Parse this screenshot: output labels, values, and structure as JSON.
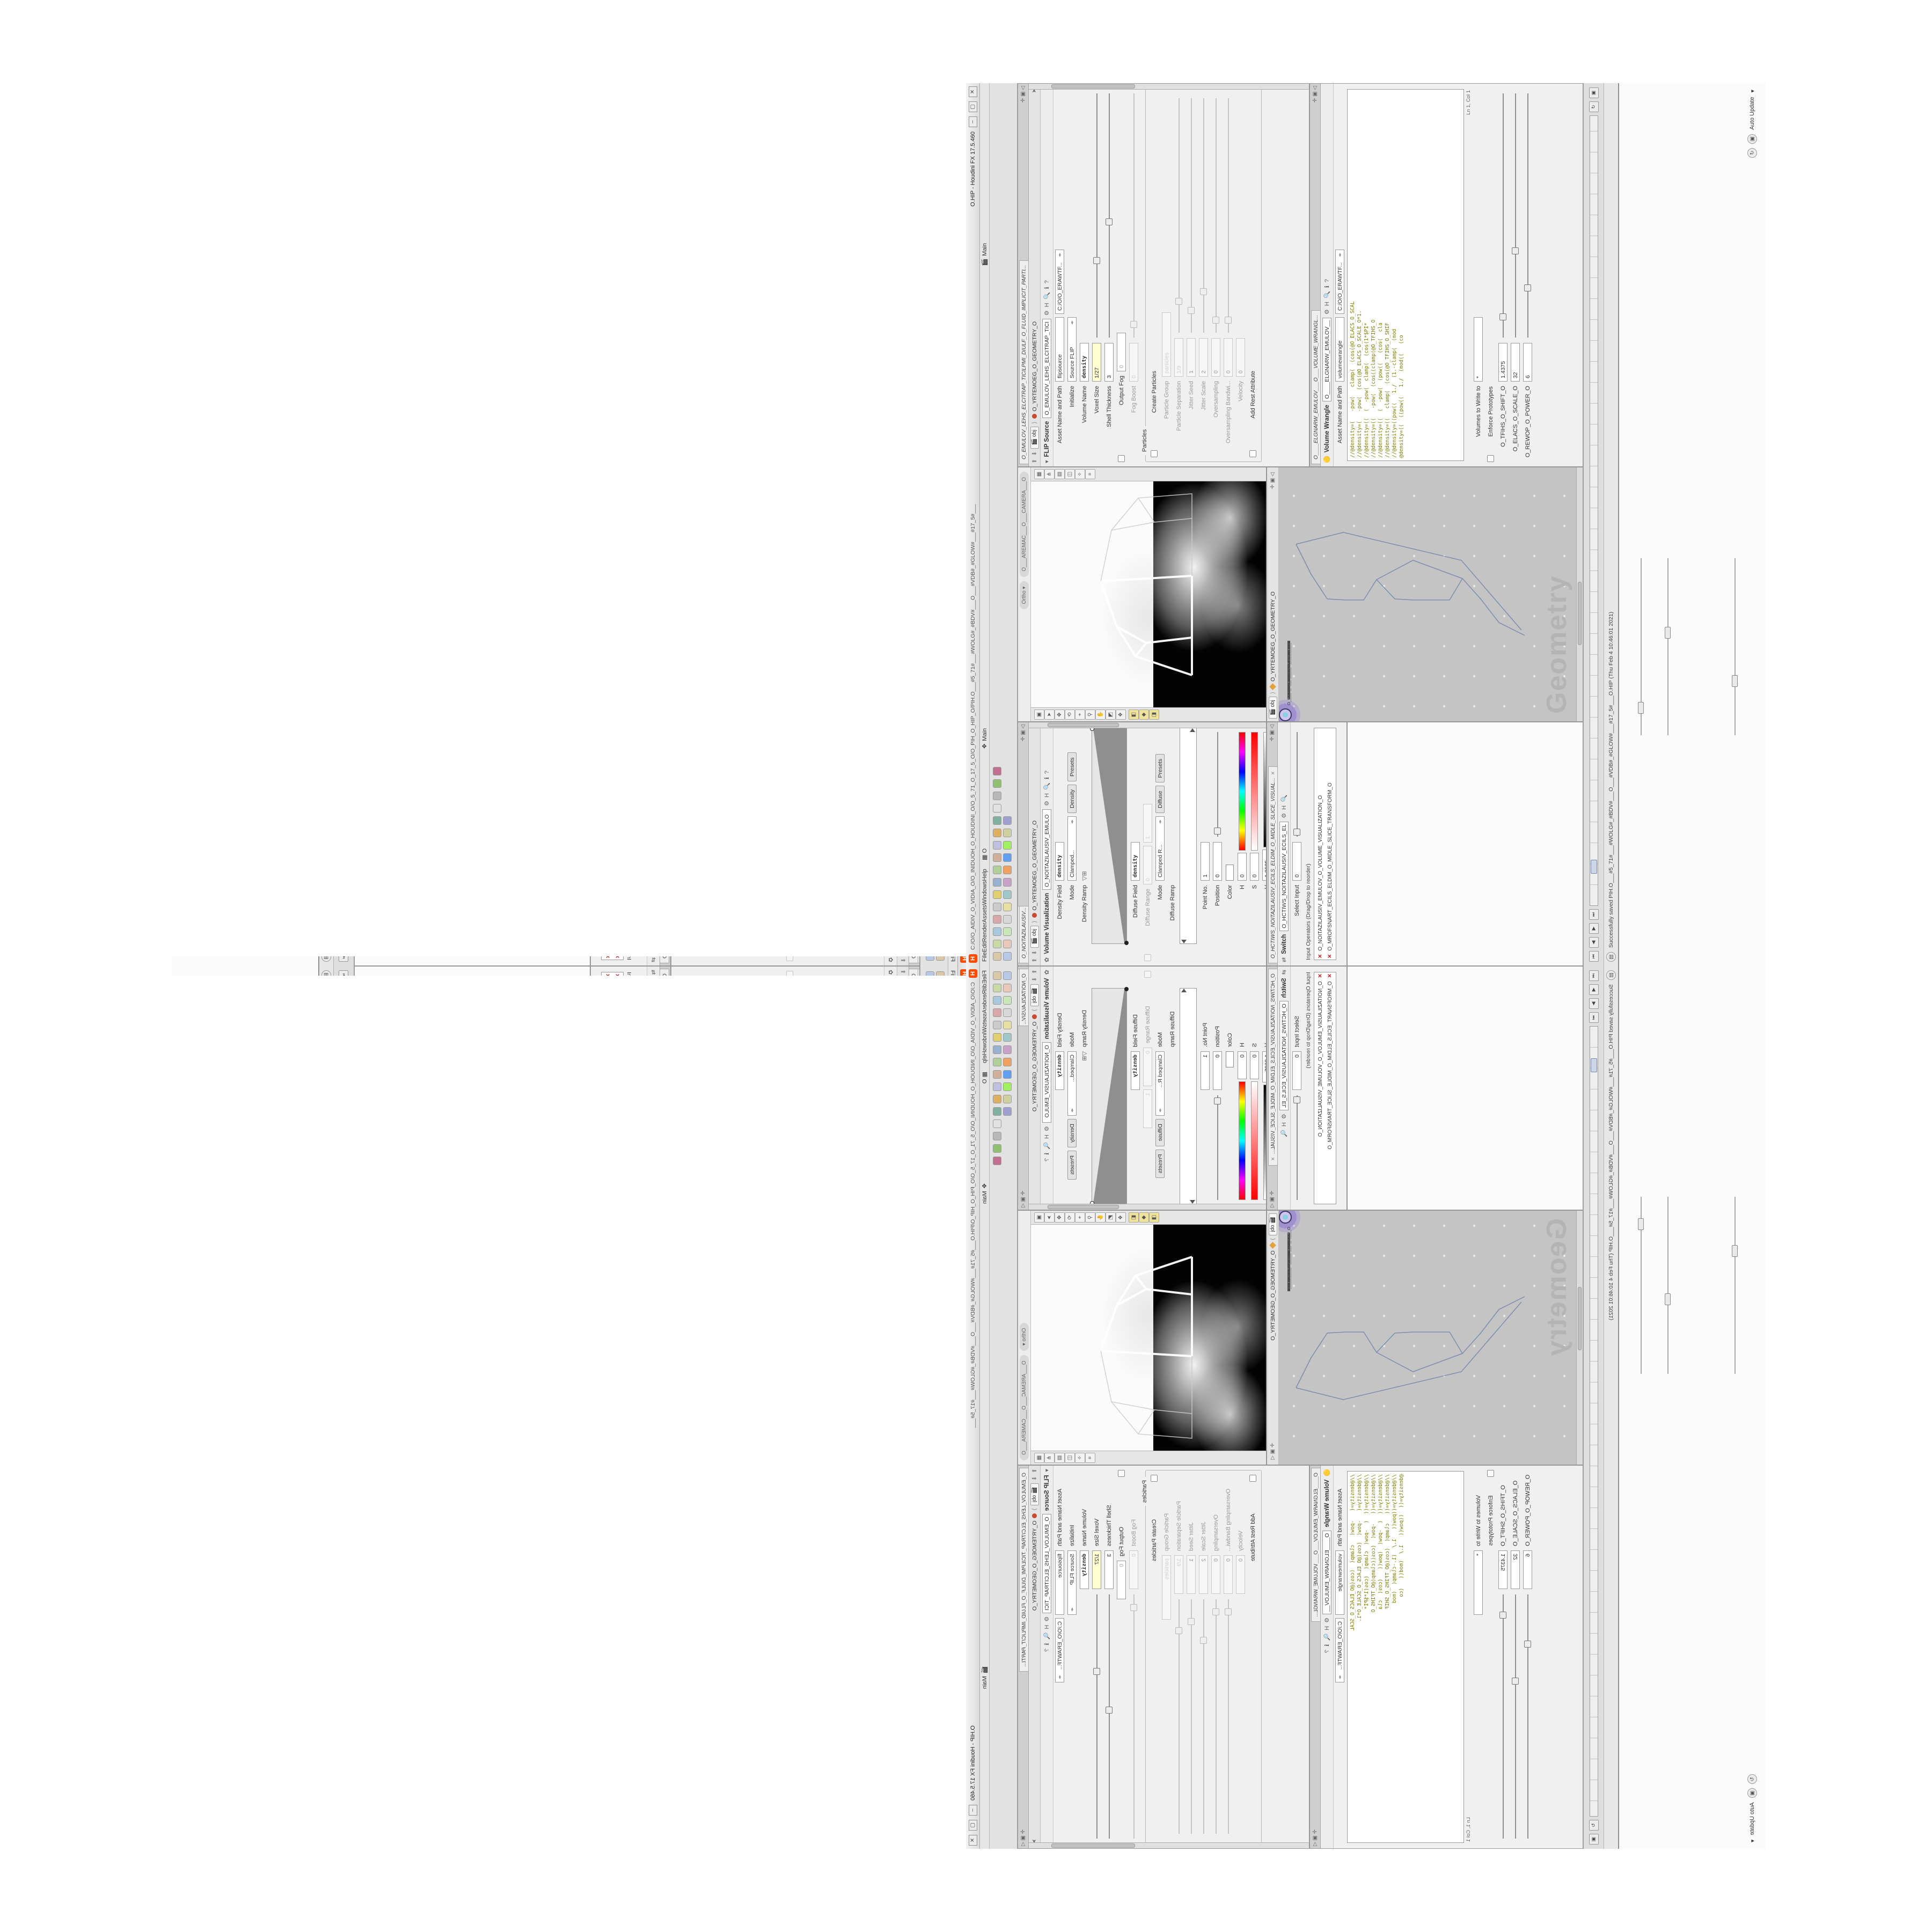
{
  "window": {
    "logo": "H",
    "title_path": "C:/O/O_AIDIV_O_VIDIA_O/O_INIDUOH_O_HOUDINI_O/O_5_71_O_17_5_O/O_PIH_O_HIP_O/PIH.O___#5_71#___#WOLG#_#BDV#___O___#VDB#_#GLOW#___#17_5#___",
    "title_app": "O.HIP - Houdini FX 17.5.460",
    "btn_min": "–",
    "btn_max": "▢",
    "btn_close": "✕"
  },
  "menu": {
    "items": [
      {
        "label": "File"
      },
      {
        "label": "Edit"
      },
      {
        "label": "Render"
      },
      {
        "label": "Assets"
      },
      {
        "label": "Windows"
      },
      {
        "label": "Help"
      }
    ],
    "grid_icon": "▦",
    "grid_label": "O",
    "desktop_label": "Main",
    "desktop_label2": "Main"
  },
  "shelf": {
    "row1": [
      {
        "style": "background:#d9c9a8"
      },
      {
        "style": "background:#c9d9a8"
      },
      {
        "style": "background:#a8c9d9"
      },
      {
        "style": "background:#d9a8a8"
      },
      {
        "style": "background:#cccccc"
      },
      {
        "style": "background:#e0d070"
      },
      {
        "style": "background:#9ab0d0"
      },
      {
        "style": "background:#b0d09a"
      },
      {
        "style": "background:#d0b09a"
      },
      {
        "style": "background:#c0c0e0"
      },
      {
        "style": "background:#e0b060"
      },
      {
        "style": "background:#80b0a0"
      },
      {
        "style": "background:#d490689"
      },
      {
        "style": "background:#b8b8b8"
      },
      {
        "style": "background:#90c070"
      },
      {
        "style": "background:#c07090"
      }
    ],
    "row2": [
      {
        "style": "background:#b8c8e8"
      },
      {
        "style": "background:#e8c8b8"
      },
      {
        "style": "background:#c8e8b8"
      },
      {
        "style": "background:#d8d8d8"
      },
      {
        "style": "background:#e8e0a0"
      },
      {
        "style": "background:#a0c8c8"
      },
      {
        "style": "background:#c8a0c8"
      },
      {
        "style": "background:#f0a060"
      },
      {
        "style": "background:#60a0f0"
      },
      {
        "style": "background:#a0f060"
      },
      {
        "style": "background:#d0d0a0"
      },
      {
        "style": "background:#a0a0d0"
      }
    ]
  },
  "breadcrumb": {
    "root": "obj",
    "node": "O_YRTEMOEG_O_GEOMETRY_O"
  },
  "volviz": {
    "tabs": [
      {
        "label": "O___ARTNAM_...",
        "close": "✕"
      },
      {
        "label": "O___AREMAC_...",
        "close": "✕"
      },
      {
        "label": "O_NOITAZILAUSIV...",
        "close": "✕"
      }
    ],
    "icon": "✿",
    "title": "Volume Visualization",
    "name_field": "O_NOITAZILAUSIV_EMULO",
    "rows": {
      "density_field_label": "Density Field",
      "density_field_value": "density",
      "mode_label": "Mode",
      "mode_value": "Clamped...",
      "mode_btn1": "Density",
      "mode_btn2": "Presets",
      "density_ramp_label": "Density Ramp",
      "diffuse_field_label": "Diffuse Field",
      "diffuse_field_value": "density",
      "diffuse_range_label": "Diffuse Range",
      "diffuse_range_v1": "0",
      "diffuse_range_v2": "1",
      "mode2_label": "Mode",
      "mode2_value": "Clamped R...",
      "mode2_btn1": "Diffuse",
      "mode2_btn2": "Presets",
      "diffuse_ramp_label": "Diffuse Ramp",
      "point_label": "Point No.",
      "point_value": "1",
      "pos_label": "Position",
      "pos_value": "0",
      "color_label": "Color",
      "h_label": "H",
      "h_value": "0",
      "s_label": "S",
      "s_value": "0",
      "v_label": "V",
      "v_value": "1.8125",
      "interp_label": "Interpolation",
      "interp_value": "Linear"
    }
  },
  "switch": {
    "tab": "O_HCTIWS_NOITAZILAUSIV_ECILS_ELDIM_O_MIDLE_SLICE_VISUAL...",
    "icon": "⇄",
    "title": "Switch",
    "name_field": "O_HCTIWS_NOITAZILAUSIV_ECILS_EL",
    "select_label": "Select Input",
    "select_value": "0",
    "list_label": "Input Operators (Drag/Drop to reorder)",
    "items": [
      {
        "x": "✕",
        "name": "O_NOITAZILAUSIV_EMULOV_O_VOLUME_VISUALIZATION_O"
      },
      {
        "x": "✕",
        "name": "O_MROFSNART_ECILS_ELDIM_O_MIDLE_SLICE_TRANSFORM_O"
      }
    ]
  },
  "viewport": {
    "ortho": "Ortho",
    "camera": "O___AREMAC___O___CAMERA___O",
    "left_icons": [
      {
        "g": "▣"
      },
      {
        "g": "➤"
      },
      {
        "g": "✥"
      },
      {
        "g": "⟲"
      },
      {
        "g": "⌖"
      },
      {
        "g": "⚲"
      },
      {
        "g": "✋"
      },
      {
        "g": "◩"
      },
      {
        "g": "❖"
      }
    ],
    "left_icons_yellow": [
      {
        "g": "◧"
      },
      {
        "g": "◆"
      },
      {
        "g": "◨"
      }
    ],
    "right_icons": [
      {
        "g": "▦"
      },
      {
        "g": "⋔"
      },
      {
        "g": "▤"
      },
      {
        "g": "◫"
      },
      {
        "g": "✧"
      },
      {
        "g": "⌗"
      }
    ]
  },
  "network": {
    "watermark": "Geometry",
    "nodes": [
      {
        "name": "O_EREHPS_EBUC_O_CUBE_SPHERE_O",
        "pos": "left:318px;top:18px",
        "dot": "background:#3f9e57",
        "cls": "node"
      },
      {
        "name": "O_ERIWYLOP_O_POLYWIRE_O",
        "pos": "left:260px;top:48px",
        "dot": "background:#8899aa",
        "cls": "node"
      },
      {
        "name": "O_ELIF_O_FILE_O",
        "pos": "left:214px;top:78px",
        "dot": "background:#b0b0b0",
        "cls": "node"
      },
      {
        "name": "O_HCTIWS_YRTEMOEG_O_GEOMETRY_SWITCH_O",
        "pos": "left:214px;top:112px",
        "dot": "background:#777777",
        "cls": "node"
      },
      {
        "name": "O_PILC_O_CLIP_O",
        "pos": "left:214px;top:146px",
        "dot": "background:#d88840",
        "cls": "node"
      },
      {
        "name": "O_PILC_ELDIM_O_MIDLE_CLIP_O",
        "pos": "left:254px;top:170px",
        "dot": "background:#d88840",
        "cls": "node"
      },
      {
        "name": "O_EMULOV_LEHS_ELCITRAP_TICILPMI_DIULF_O",
        "pos": "left:214px;top:204px",
        "dot": "background:#cccccc",
        "cls": "node"
      },
      {
        "name": "O_SNOGYLOP_MORF_BDV_O_VDB_FROM_POLYGONS_O",
        "pos": "left:214px;top:238px",
        "dot": "background:#c86060",
        "cls": "node"
      },
      {
        "name": "O____ELGNARW_EMULOV_O_VOLUME_WRANGLE____O",
        "pos": "left:214px;top:272px",
        "dot": "background:#c8b840",
        "cls": "node"
      },
      {
        "name": "O_NOITAZILAUSIV_EMULOV_O_VOLUME_VISUALIZATION_O",
        "pos": "left:214px;top:306px",
        "dot": "background:#70a8c8",
        "cls": "node"
      },
      {
        "name": "O_MROFSNART_ECILS_ELDIM_O_MIDLE_SLICE_TRANSFORM_O",
        "pos": "left:256px;top:330px",
        "dot": "background:#6a88c0",
        "cls": "node"
      },
      {
        "name": "O_HCTIWS_NOITAZILAUSIV_ECILS_ELDIM_O",
        "pos": "left:214px;top:364px",
        "dot": "background:#222222",
        "cls": "node"
      },
      {
        "name": "O_ECRUOS_HTIW_EMULOV_O_VOLUME_WITH_SOURCE_O",
        "pos": "left:170px;top:398px",
        "dot": "background:#9a9a9a",
        "cls": "node"
      },
      {
        "name": "O_MROFSNART_TLUSER_O_RESULT_TRANSFORM_O",
        "pos": "left:146px;top:446px",
        "dot": "background:#8ad0e0",
        "cls": "node sel"
      }
    ]
  },
  "flip": {
    "tab": "O_EMULOV_LEHS_ELCITRAP_TICILPMI_DIULF_O_FLUID_IMPLICIT_PARTI...",
    "title": "FLIP Source",
    "name_field": "O_EMULOV_LEHS_ELCITRAP_TICI",
    "asset_label": "Asset Name and Path",
    "asset_v1": "flipsource",
    "asset_v2": "C:/O/O_ERAWTF...",
    "params": [
      {
        "rcls": "prow",
        "cbcls": "none",
        "label": "Initialize",
        "value": "Source FLIP",
        "vcls": "pfield wide arrows",
        "scls": "sl h",
        "hs": "left:0%"
      },
      {
        "rcls": "prow",
        "cbcls": "none",
        "label": "Volume Name",
        "value": "density",
        "vcls": "pfield bold",
        "scls": "sl h",
        "hs": "left:0%"
      },
      {
        "rcls": "prow",
        "cbcls": "none",
        "label": "Voxel Size",
        "value": "1/27",
        "vcls": "pfield yellow",
        "scls": "sl",
        "hs": "left:30%"
      },
      {
        "rcls": "prow",
        "cbcls": "none",
        "label": "Shell Thickness",
        "value": "3",
        "vcls": "pfield",
        "scls": "sl",
        "hs": "left:46%"
      },
      {
        "rcls": "prow",
        "cbcls": "cb",
        "label": "Output Fog",
        "value": "0",
        "vcls": "pfield ghost",
        "scls": "sl h",
        "hs": "left:0%"
      },
      {
        "rcls": "prow dim",
        "cbcls": "none",
        "label": "Fog Boost",
        "value": "0",
        "vcls": "pfield ghost",
        "scls": "sl",
        "hs": "left:4%"
      }
    ],
    "particles_group": "Particles",
    "pparams": [
      {
        "rcls": "prow",
        "cbcls": "cb",
        "label": "Create Particles",
        "value": "",
        "vcls": "none",
        "scls": "sl h",
        "hs": "left:0%"
      },
      {
        "rcls": "prow dim",
        "cbcls": "none",
        "label": "Particle Group",
        "value": "particles",
        "vcls": "pfield ghost wide",
        "scls": "sl h",
        "hs": "left:0%"
      },
      {
        "rcls": "prow dim",
        "cbcls": "none",
        "label": "Particle Separation",
        "value": "1/9",
        "vcls": "pfield ghost",
        "scls": "sl",
        "hs": "left:12%"
      },
      {
        "rcls": "prow dim",
        "cbcls": "none",
        "label": "Jitter Seed",
        "value": "1",
        "vcls": "pfield",
        "scls": "sl",
        "hs": "left:8%"
      },
      {
        "rcls": "prow dim",
        "cbcls": "none",
        "label": "Jitter Scale",
        "value": "2",
        "vcls": "pfield",
        "scls": "sl",
        "hs": "left:16%"
      },
      {
        "rcls": "prow dim",
        "cbcls": "none",
        "label": "Oversampling",
        "value": "0",
        "vcls": "pfield",
        "scls": "sl",
        "hs": "left:4%"
      },
      {
        "rcls": "prow dim",
        "cbcls": "none",
        "label": "Oversampling Bandwi...",
        "value": "0",
        "vcls": "pfield",
        "scls": "sl",
        "hs": "left:4%"
      },
      {
        "rcls": "prow dim",
        "cbcls": "none",
        "label": "Velocity",
        "value": "0",
        "vcls": "pfield",
        "scls": "sl h",
        "hs": "left:0%"
      },
      {
        "rcls": "prow",
        "cbcls": "cb",
        "label": "Add Rest Attribute",
        "value": "",
        "vcls": "none",
        "scls": "sl h",
        "hs": "left:0%"
      }
    ]
  },
  "wrangle": {
    "tab": "O____ELGNARW_EMULOV___O___VOLUME_WRANGL...",
    "title": "Volume Wrangle",
    "name_field": "O____ELGNARW_EMULOV__",
    "asset_label": "Asset Name and Path",
    "asset_v1": "volumewrangle",
    "asset_v2": "C:/O/O_ERAWTF...",
    "code": [
      {
        "line": "//@density=(   -pow(   clamp(  (cos(@O_ELACS_O_SCAL"
      },
      {
        "line": "//@density=(   -pow(  (cos(@O_ELACS_O_SCALE_O*1."
      },
      {
        "line": "//@density=((  (  -pow(  clamp(  (cos(1*$PI*"
      },
      {
        "line": "//@density=((   -pow(  (cos((clamp(@O_TFIHS_O"
      },
      {
        "line": "//@density=((  (  -pow(  (pow((   (cos(  cla"
      },
      {
        "line": "//@density=((   clamp(  (cos(@O_TFIHS_O_SHIF"
      },
      {
        "line": "//@density=((pow((   1./  (1.-clamp(  (mod"
      },
      {
        "line": "@density=((  ((pow((   1./  (mod((   (co"
      }
    ],
    "lncol": "Ln 1, Col 1",
    "volumes_label": "Volumes to Write to",
    "volumes_value": "*",
    "enforce_label": "Enforce Prototypes",
    "spare": [
      {
        "rcls": "prow",
        "cbcls": "none",
        "label": "O_TFIHS_O_SHIFT_O",
        "value": "1.4375",
        "vcls": "pfield",
        "scls": "sl",
        "hs": "left:7%"
      },
      {
        "rcls": "prow",
        "cbcls": "none",
        "label": "O_ELACS_O_SCALE_O",
        "value": "32",
        "vcls": "pfield",
        "scls": "sl",
        "hs": "left:34%"
      },
      {
        "rcls": "prow",
        "cbcls": "none",
        "label": "O_REWOP_O_POWER_O",
        "value": "6",
        "vcls": "pfield",
        "scls": "sl",
        "hs": "left:19%"
      }
    ]
  },
  "playbar": {
    "b1": "⏮",
    "b2": "◀",
    "b3": "▶",
    "b4": "⏭",
    "upd1": "↻",
    "upd2": "▣"
  },
  "status": {
    "icon": "▤",
    "message": "Successfully saved PIH.O___#5_71#___#WOLG#_#BDV#___O___#VDB#_#GLOW#___#17_5#___O.HIP (Thu Feb 4 10:46:01 2021)"
  },
  "bottomband": {
    "auto_update": "Auto Update",
    "au_caret": "▾",
    "i1": "↻",
    "i2": "▣"
  }
}
